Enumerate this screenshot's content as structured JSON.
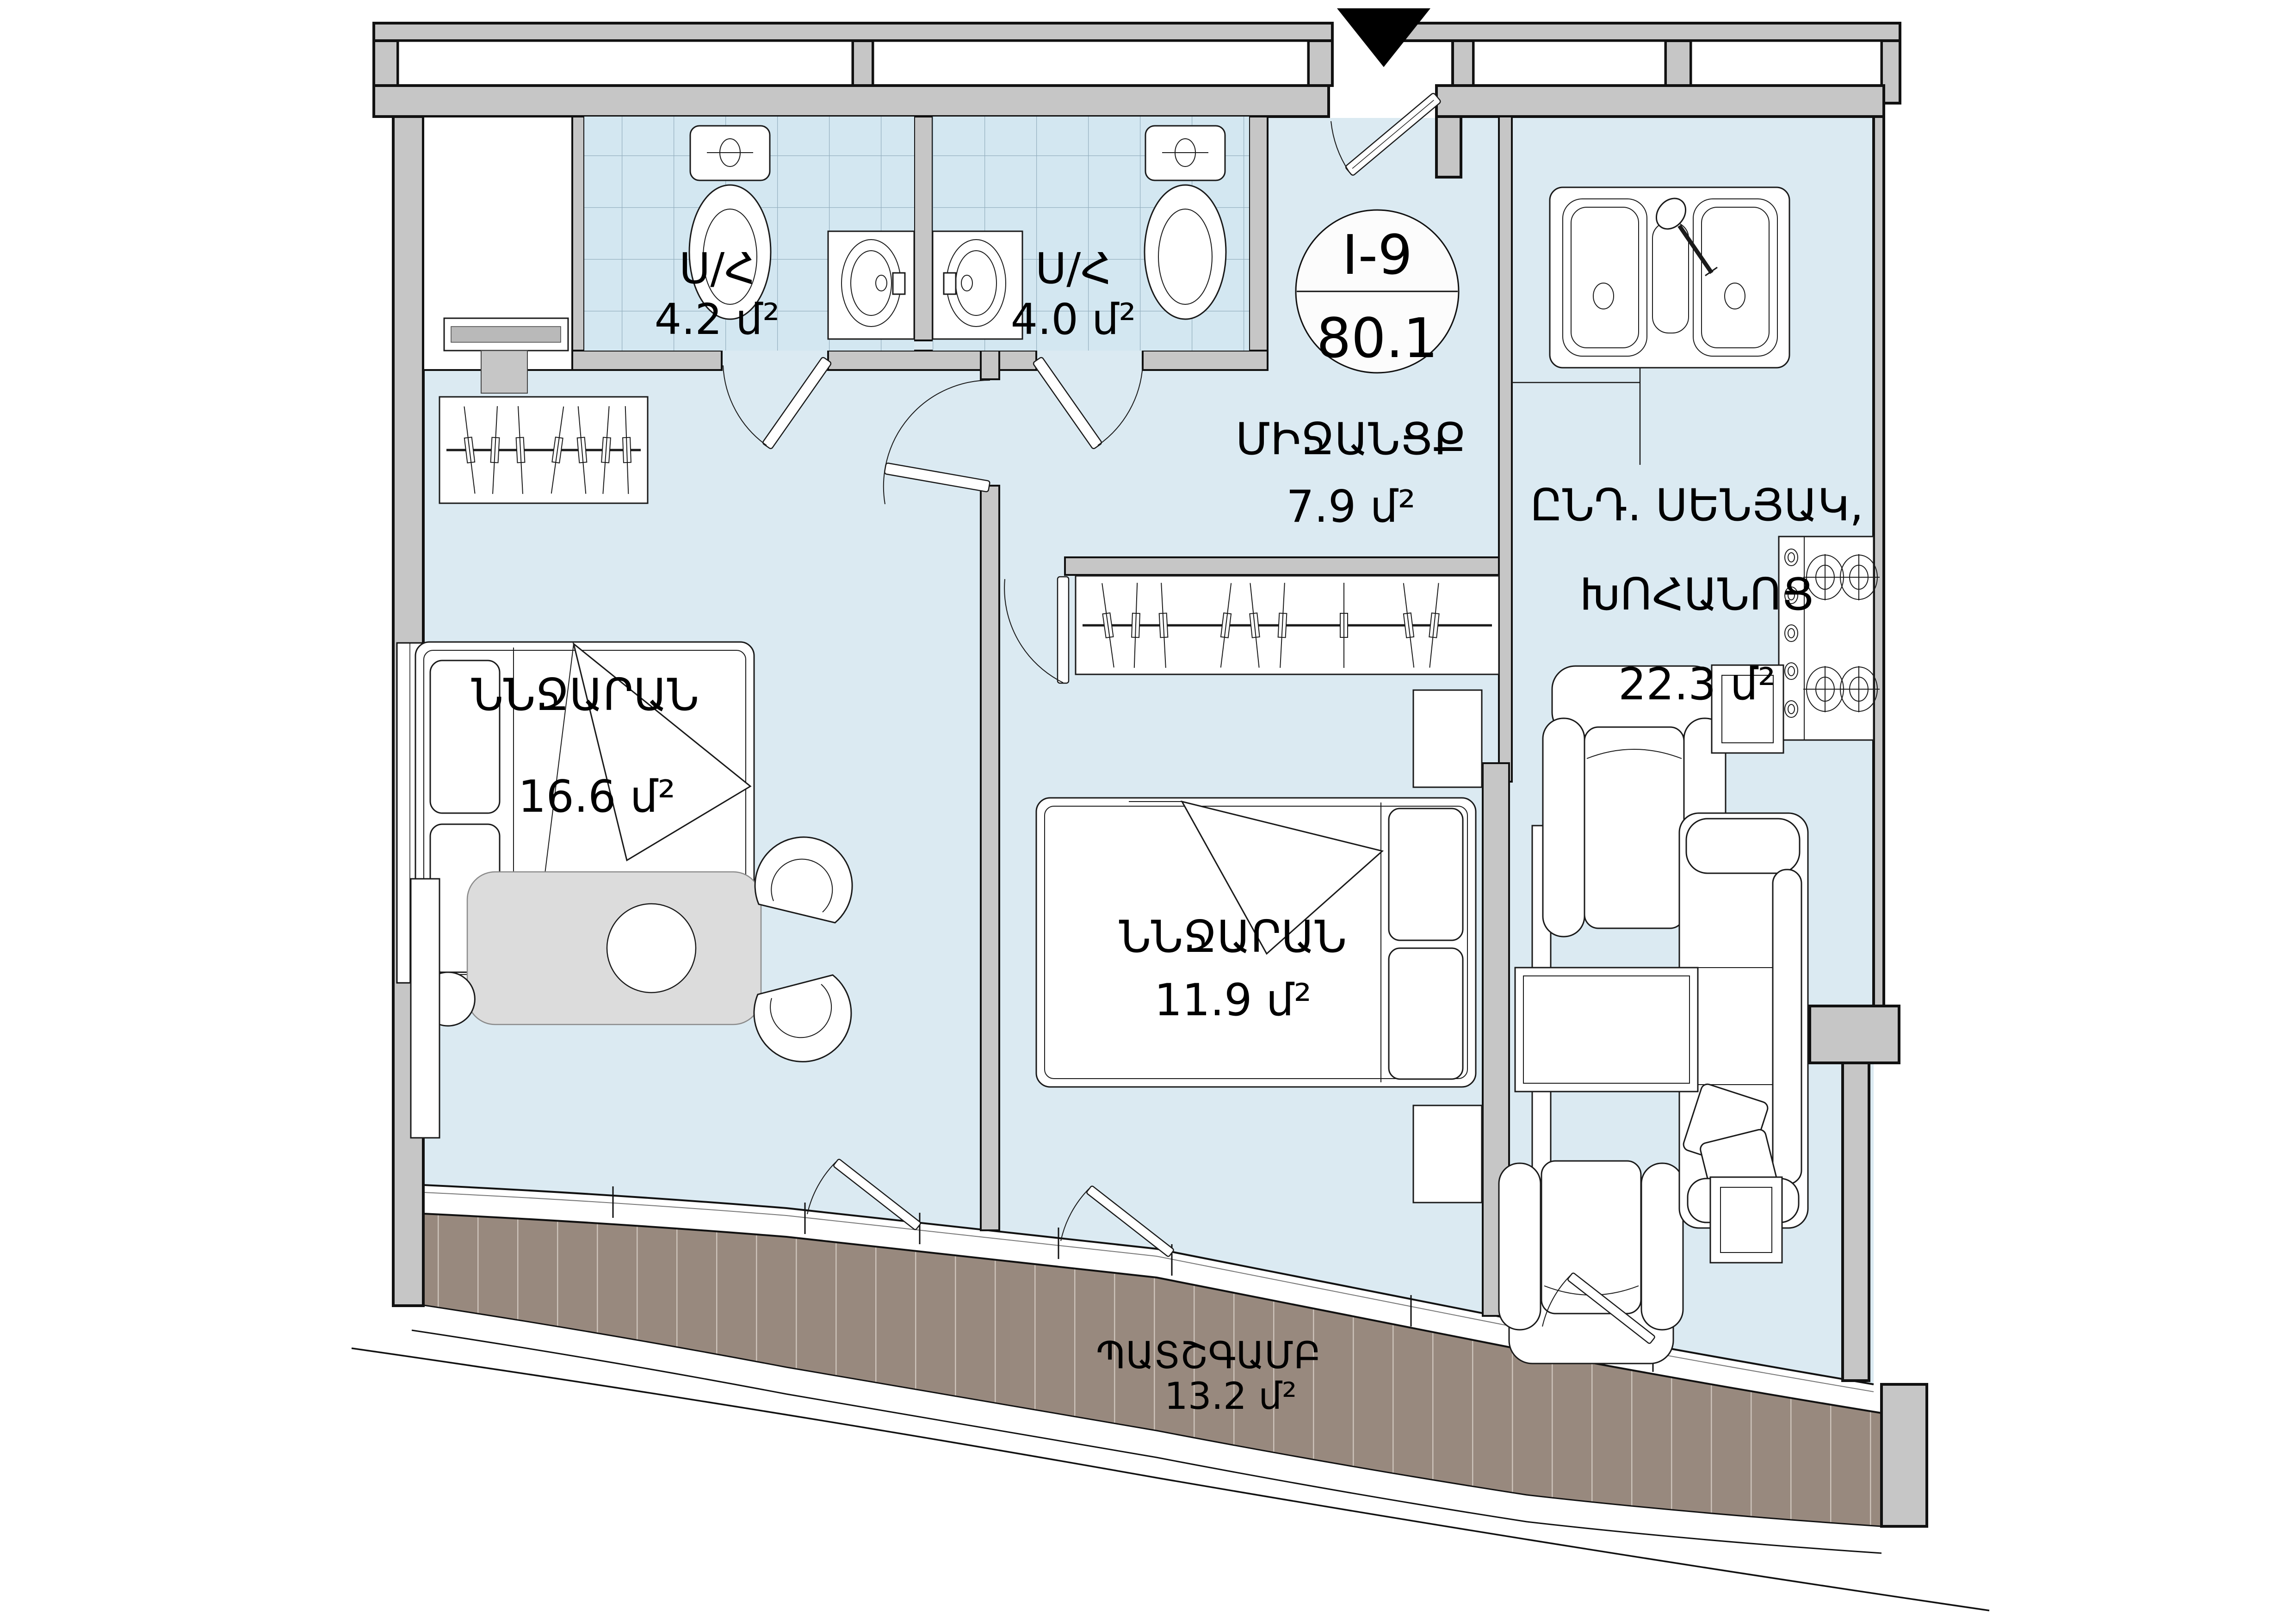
{
  "plan": {
    "badge": {
      "code": "I-9",
      "area": "80.1"
    },
    "rooms": [
      {
        "id": "bathroom-1",
        "name": "Ս/Հ",
        "area": "4.2 մ²"
      },
      {
        "id": "bathroom-2",
        "name": "Ս/Հ",
        "area": "4.0 մ²"
      },
      {
        "id": "hallway",
        "name": "ՄԻՋԱՆՑՔ",
        "area": "7.9 մ²"
      },
      {
        "id": "living-kitchen",
        "line1": "ԸՆԴ. ՍԵՆՅԱԿ,",
        "line2": "ԽՈՀԱՆՈՑ",
        "area": "22.3 մ²"
      },
      {
        "id": "bedroom-1",
        "name": "ՆՆՋԱՐԱՆ",
        "area": "16.6 մ²"
      },
      {
        "id": "bedroom-2",
        "name": "ՆՆՋԱՐԱՆ",
        "area": "11.9 մ²"
      },
      {
        "id": "balcony",
        "name": "ՊԱՏՇԳԱՄԲ",
        "area": "13.2 մ²"
      }
    ],
    "colors": {
      "floor": "#dbeaf2",
      "bath_tile": "#d3e7f1",
      "wall": "#c6c6c6",
      "balcony_deck": "#98897e",
      "outline": "#111111"
    }
  }
}
